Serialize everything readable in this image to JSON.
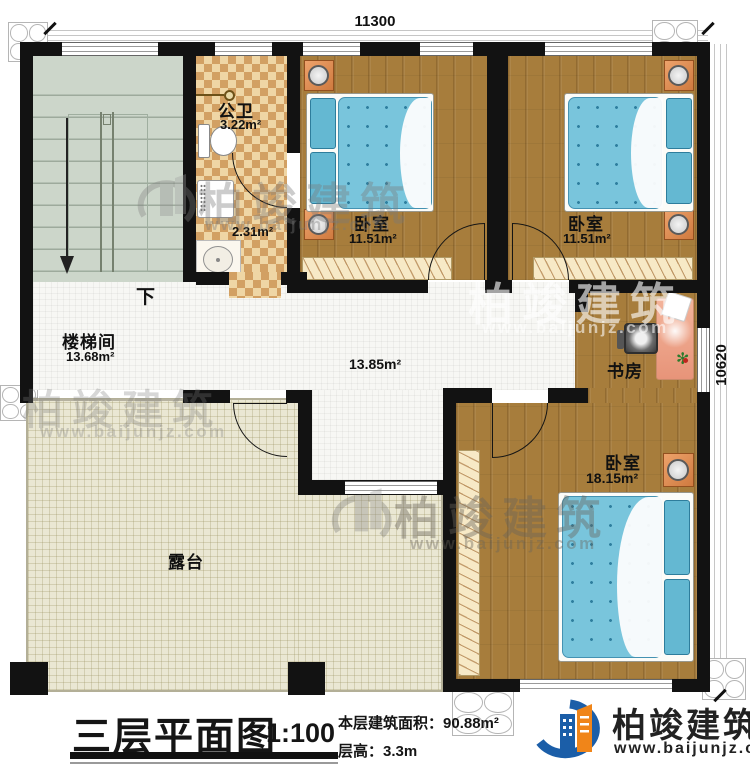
{
  "dimensions": {
    "top": "11300",
    "right": "10620"
  },
  "rooms": {
    "stairwell": {
      "name": "楼梯间",
      "area": "13.68m²",
      "down_label": "下"
    },
    "bathroom": {
      "name": "公卫",
      "area": "3.22m²",
      "sub_area": "2.31m²"
    },
    "bedroom1": {
      "name": "卧室",
      "area": "11.51m²"
    },
    "bedroom2": {
      "name": "卧室",
      "area": "11.51m²"
    },
    "bedroom3": {
      "name": "卧室",
      "area": "18.15m²"
    },
    "study": {
      "name": "书房"
    },
    "hall": {
      "area": "13.85m²"
    },
    "terrace": {
      "name": "露台"
    }
  },
  "title_block": {
    "title": "三层平面图",
    "scale": "1:100",
    "floor_area_label": "本层建筑面积：",
    "floor_area_value": "90.88m²",
    "floor_height_label": "层高：",
    "floor_height_value": "3.3m"
  },
  "branding": {
    "company": "柏竣建筑",
    "website": "www.baijunjz.com"
  },
  "watermark": {
    "company": "柏竣建筑",
    "website": "www.baijunjz.com"
  },
  "colors": {
    "wall": "#121212",
    "wood_floor": "#a77d3c",
    "mattress_blue": "#79c5dc",
    "checker_light": "#efd6a5",
    "checker_dark": "#d2a063",
    "stairs_floor": "#ccd6ca",
    "terrace_floor": "#eae7d3",
    "nightstand_orange": "#cf7a3f",
    "logo_blue": "#1b5ea8",
    "logo_orange": "#f08519"
  }
}
